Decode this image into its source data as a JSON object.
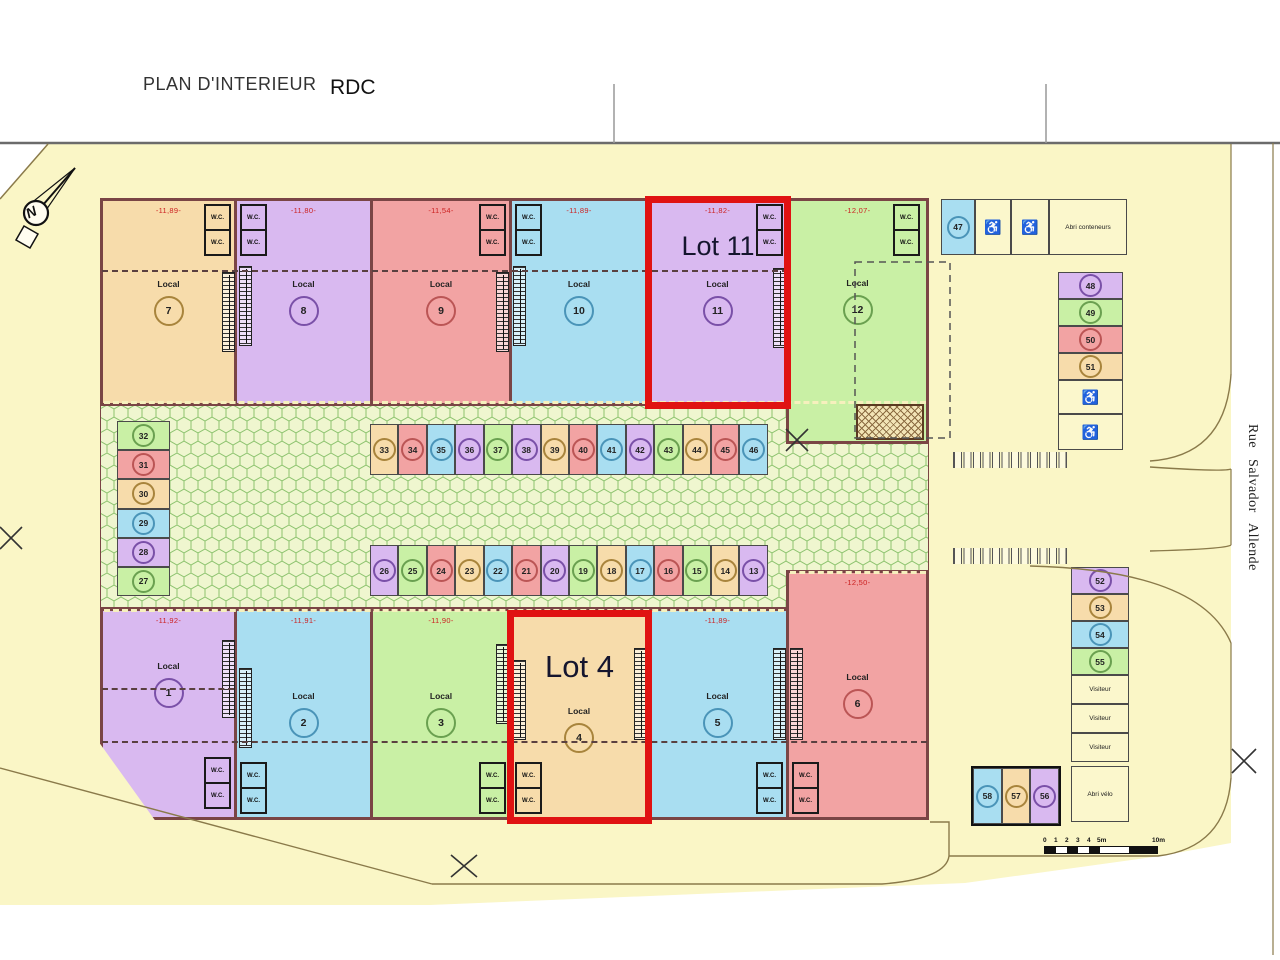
{
  "header": {
    "title": "PLAN D'INTERIEUR",
    "floor": "RDC"
  },
  "compass": {
    "label": "N"
  },
  "street_name": "Rue Salvador Allende",
  "labels": {
    "wc": "W.C.",
    "local": "Local",
    "visiteur": "Visiteur",
    "abri_conteneurs": "Abri conteneurs",
    "abri_velo": "Abri vélo",
    "wheelchair": "♿"
  },
  "highlights": {
    "lot11": "Lot 11",
    "lot4": "Lot 4"
  },
  "locals_top": [
    {
      "num": "7",
      "color": "orange",
      "dim": "-11,89-"
    },
    {
      "num": "8",
      "color": "purple",
      "dim": "-11,80-"
    },
    {
      "num": "9",
      "color": "red",
      "dim": "-11,54-"
    },
    {
      "num": "10",
      "color": "blue",
      "dim": "-11,89-"
    },
    {
      "num": "11",
      "color": "purple",
      "dim": "-11,82-"
    },
    {
      "num": "12",
      "color": "green",
      "dim": "-12,07-"
    }
  ],
  "locals_bottom": [
    {
      "num": "1",
      "color": "purple",
      "dim": "-11,92-"
    },
    {
      "num": "2",
      "color": "blue",
      "dim": "-11,91-"
    },
    {
      "num": "3",
      "color": "green",
      "dim": "-11,90-"
    },
    {
      "num": "4",
      "color": "orange",
      "dim": ""
    },
    {
      "num": "5",
      "color": "blue",
      "dim": "-11,89-"
    },
    {
      "num": "6",
      "color": "red",
      "dim": "-12,50-"
    }
  ],
  "parking": {
    "left_column": [
      {
        "num": "32",
        "color": "green"
      },
      {
        "num": "31",
        "color": "red"
      },
      {
        "num": "30",
        "color": "orange"
      },
      {
        "num": "29",
        "color": "blue"
      },
      {
        "num": "28",
        "color": "purple"
      },
      {
        "num": "27",
        "color": "green"
      }
    ],
    "top_row": [
      {
        "num": "33",
        "color": "orange"
      },
      {
        "num": "34",
        "color": "red"
      },
      {
        "num": "35",
        "color": "blue"
      },
      {
        "num": "36",
        "color": "purple"
      },
      {
        "num": "37",
        "color": "green"
      },
      {
        "num": "38",
        "color": "purple"
      },
      {
        "num": "39",
        "color": "orange"
      },
      {
        "num": "40",
        "color": "red"
      },
      {
        "num": "41",
        "color": "blue"
      },
      {
        "num": "42",
        "color": "purple"
      },
      {
        "num": "43",
        "color": "green"
      },
      {
        "num": "44",
        "color": "orange"
      },
      {
        "num": "45",
        "color": "red"
      },
      {
        "num": "46",
        "color": "blue"
      }
    ],
    "bottom_row": [
      {
        "num": "26",
        "color": "purple"
      },
      {
        "num": "25",
        "color": "green"
      },
      {
        "num": "24",
        "color": "red"
      },
      {
        "num": "23",
        "color": "orange"
      },
      {
        "num": "22",
        "color": "blue"
      },
      {
        "num": "21",
        "color": "red"
      },
      {
        "num": "20",
        "color": "purple"
      },
      {
        "num": "19",
        "color": "green"
      },
      {
        "num": "18",
        "color": "orange"
      },
      {
        "num": "17",
        "color": "blue"
      },
      {
        "num": "16",
        "color": "red"
      },
      {
        "num": "15",
        "color": "green"
      },
      {
        "num": "14",
        "color": "orange"
      },
      {
        "num": "13",
        "color": "purple"
      }
    ],
    "spot_47": {
      "num": "47",
      "color": "blue"
    },
    "right_stack_a": [
      {
        "num": "48",
        "color": "purple"
      },
      {
        "num": "49",
        "color": "green"
      },
      {
        "num": "50",
        "color": "red"
      },
      {
        "num": "51",
        "color": "orange"
      }
    ],
    "right_stack_b": [
      {
        "num": "52",
        "color": "purple"
      },
      {
        "num": "53",
        "color": "orange"
      },
      {
        "num": "54",
        "color": "blue"
      },
      {
        "num": "55",
        "color": "green"
      }
    ],
    "trio": [
      {
        "num": "58",
        "color": "blue"
      },
      {
        "num": "57",
        "color": "orange"
      },
      {
        "num": "56",
        "color": "purple"
      }
    ]
  },
  "scalebar": {
    "ticks": [
      "0",
      "1",
      "2",
      "3",
      "4",
      "5m"
    ],
    "end": "10m"
  }
}
